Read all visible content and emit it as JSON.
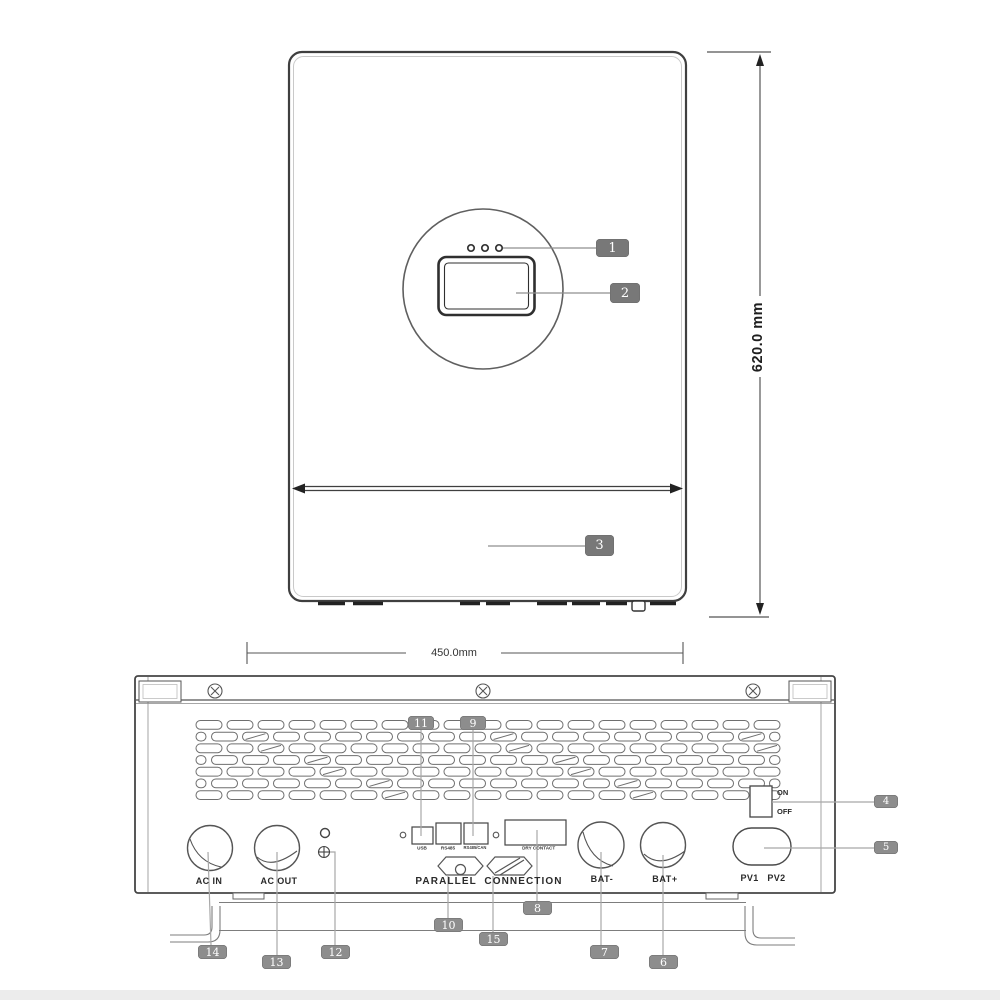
{
  "dimensions": {
    "height_label": "620.0 mm",
    "width_label": "450.0mm"
  },
  "bottom_panel": {
    "ac_in": "AC IN",
    "ac_out": "AC OUT",
    "usb": "USB",
    "rs485": "RS485",
    "rs485_can": "RS485/CAN",
    "dry_contact": "DRY CONTACT",
    "parallel_connection": "PARALLEL  CONNECTION",
    "bat_minus": "BAT-",
    "bat_plus": "BAT+",
    "switch_on": "ON",
    "switch_off": "OFF",
    "pv": "PV1   PV2",
    "vents": {
      "rows": 7,
      "cols": 19
    }
  },
  "callouts": {
    "c1": "1",
    "c2": "2",
    "c3": "3",
    "c4": "4",
    "c5": "5",
    "c6": "6",
    "c7": "7",
    "c8": "8",
    "c9": "9",
    "c10": "10",
    "c11": "11",
    "c12": "12",
    "c13": "13",
    "c14": "14",
    "c15": "15"
  },
  "colors": {
    "outline": "#454545",
    "leader": "#a0a0a0",
    "callout_front": "#787878",
    "callout_bottom": "#8d8d8d"
  }
}
